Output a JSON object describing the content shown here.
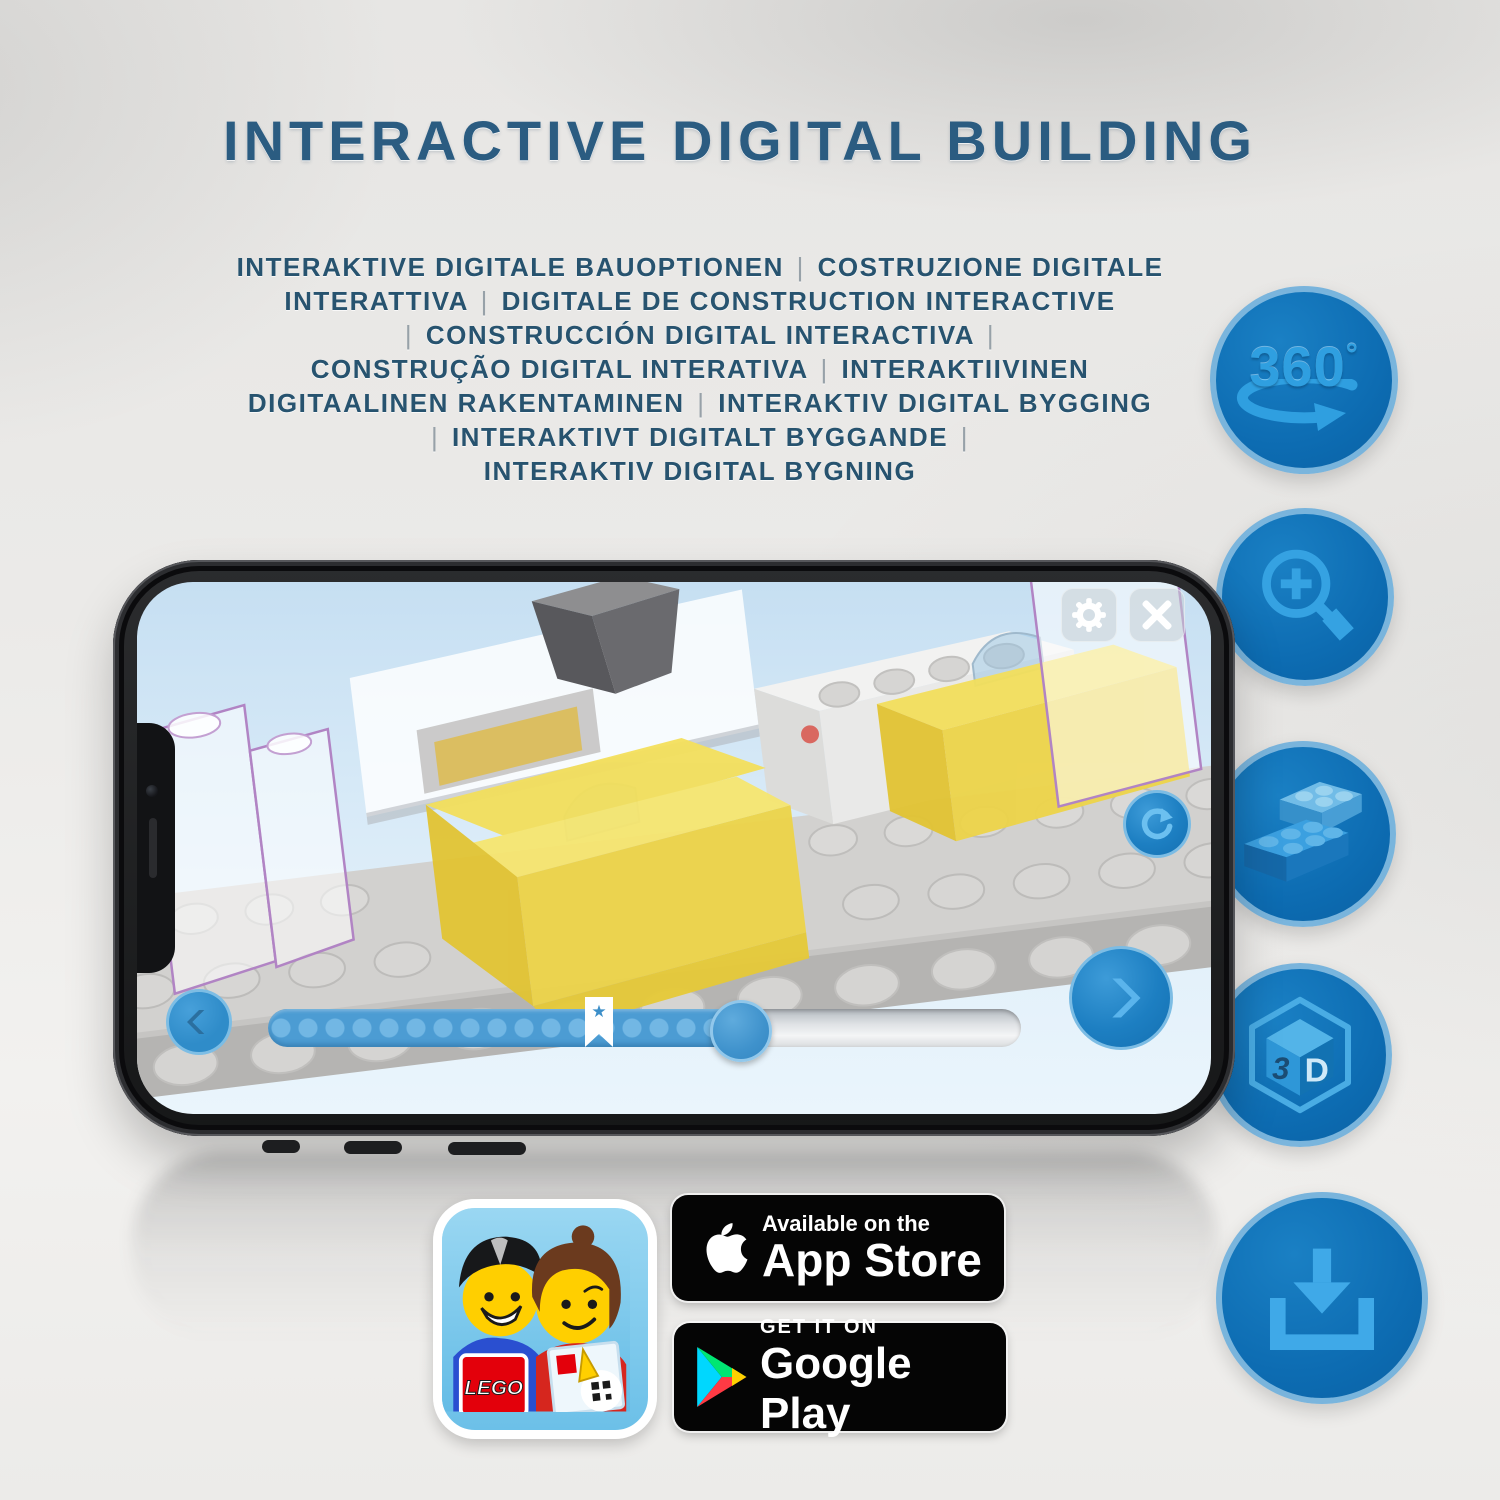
{
  "page": {
    "title": "INTERACTIVE DIGITAL BUILDING"
  },
  "subtitle_lines": [
    "INTERAKTIVE DIGITALE BAUOPTIONEN | COSTRUZIONE DIGITALE",
    "INTERATTIVA | DIGITALE DE CONSTRUCTION INTERACTIVE",
    "| CONSTRUCCIÓN DIGITAL INTERACTIVA |",
    "CONSTRUÇÃO DIGITAL INTERATIVA | INTERAKTIIVINEN",
    "DIGITAALINEN RAKENTAMINEN | INTERAKTIV DIGITAL BYGGING",
    "| INTERAKTIVT DIGITALT BYGGANDE |",
    "INTERAKTIV DIGITAL BYGNING"
  ],
  "feature_badges": [
    {
      "name": "360-rotation",
      "label": "360",
      "degree": "°"
    },
    {
      "name": "zoom-in"
    },
    {
      "name": "brick-options"
    },
    {
      "name": "3d-view",
      "cube_left": "3",
      "cube_right": "D"
    },
    {
      "name": "download-instructions"
    }
  ],
  "phone_app": {
    "progress": {
      "bookmark_star": "★"
    }
  },
  "store_badges": {
    "app_store": {
      "line1": "Available on the",
      "line2": "App Store"
    },
    "google_play": {
      "line1": "GET IT ON",
      "line2": "Google Play"
    }
  },
  "app_icon": {
    "logo_text": "LEGO"
  },
  "colors": {
    "headline_blue": "#2b5c81",
    "subtitle_blue": "#27536f",
    "badge_circle_fill": "#0d6cb2",
    "badge_circle_border": "#80b8de",
    "badge_glyph_blue": "#35a2e2",
    "app_accent_blue": "#2f8cc9",
    "lego_red": "#e3000b",
    "brick_yellow": "#edd449",
    "play_cyan": "#00d7fe",
    "play_green": "#00e673",
    "play_yellow": "#ffd000",
    "play_red": "#ff3a44"
  }
}
